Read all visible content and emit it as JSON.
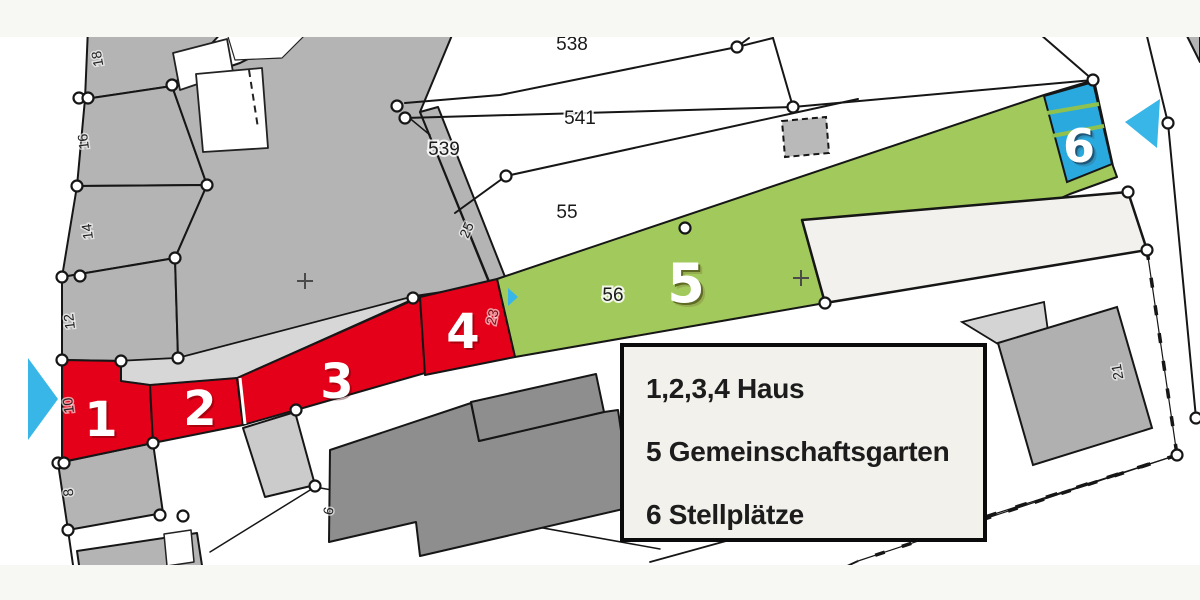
{
  "plan": {
    "title": "Lageplan",
    "legend": {
      "entries": [
        {
          "text": "1,2,3,4 Haus"
        },
        {
          "text": "5 Gemeinschaftsgarten"
        },
        {
          "text": "6 Stellplätze"
        }
      ]
    },
    "zones": {
      "z1": "1",
      "z2": "2",
      "z3": "3",
      "z4": "4",
      "z5": "5",
      "z6": "6"
    },
    "parcels": {
      "p538": "538",
      "p541": "541",
      "p539": "539",
      "p55": "55",
      "p56": "56",
      "p25": "25",
      "p23": "23",
      "p21": "21",
      "p18": "18",
      "p16": "16",
      "p14": "14",
      "p12": "12",
      "p10": "10",
      "p8": "8",
      "p6": "6"
    },
    "colors": {
      "house_red": "#e30018",
      "garden_green": "#a2c95c",
      "parking_blue": "#29a9de",
      "arrow_cyan": "#38b6e8",
      "parcel_gray": "#b4b4b4",
      "building_dark_gray": "#8e8e8e",
      "street_gray": "#d7d7d7",
      "band_offwhite": "#f7f7f4",
      "building_offwhite": "#f2f1ed",
      "legend_bg": "#f2f1ec",
      "line_black": "#161616"
    },
    "icons": [
      "arrow-left-marker",
      "arrow-right-marker",
      "entry-arrow-small",
      "plus-survey-mark"
    ]
  }
}
